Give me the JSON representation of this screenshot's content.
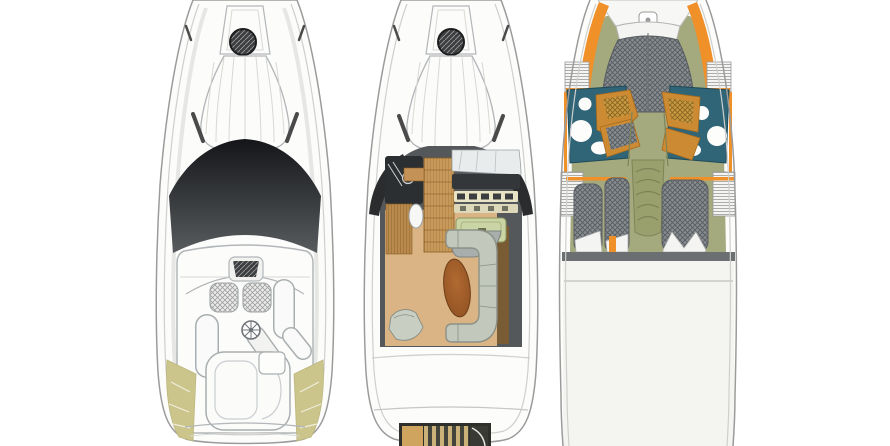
{
  "image": {
    "kind": "yacht-floorplan-diagram",
    "description": "Three top-down deck plans of a motor yacht: exterior deck plan, main deck plan, lower deck accommodation plan",
    "background": "#ffffff"
  },
  "views": [
    {
      "id": "exterior-deck-plan",
      "position": "left",
      "features": [
        "anchor-locker",
        "bow-hatch",
        "bow-sunpad",
        "grab-rails",
        "windshield",
        "helm-seats",
        "steering-wheel",
        "side-benches",
        "stern-sunpad",
        "khaki-trim",
        "swim-platform"
      ]
    },
    {
      "id": "main-deck-plan",
      "position": "center",
      "features": [
        "anchor-locker",
        "bow-hatch",
        "bow-sunpad",
        "cockpit-surround",
        "galley",
        "wood-cabinet",
        "helm-dashboard",
        "chart-table",
        "helm-seat",
        "salon-floor",
        "c-shaped-sofa",
        "oval-table",
        "chair",
        "transom",
        "engine-hatch"
      ]
    },
    {
      "id": "lower-deck-plan",
      "position": "right",
      "features": [
        "foredeck",
        "anchor-fitting",
        "v-berth",
        "head-port",
        "head-starboard",
        "vanity-seats",
        "wardrobe-lockers",
        "companionway-stairs",
        "aft-berths",
        "pillows",
        "bulkhead-band",
        "hull-seam"
      ]
    }
  ],
  "colors": {
    "background": "#ffffff",
    "hull_fill": "#fcfcfb",
    "hull_line": "#9b9b9b",
    "hull_inner_line": "#cfcfcd",
    "hull_soft_line": "#e6e6e4",
    "detail_line": "#b2b6b8",
    "faint_line": "#d8d8d6",
    "glass_dark": "#141518",
    "glass_mid": "#585c5e",
    "hatch_circle": "#3c3e40",
    "hatch_circle_line": "#9a9d9f",
    "seat_hatch_bg": "#ebebea",
    "seat_hatch_line": "#a0a0a0",
    "gray_fixture": "#a9aeb0",
    "khaki": "#cbc58b",
    "khaki_line": "#bdb77f",
    "house_dark": "#54585a",
    "wing_dark": "#2a2c2e",
    "counter_dark": "#2c2f31",
    "wood_light": "#c79a5c",
    "wood_grain": "#9a6c2c",
    "wood_floor": "#b98a4e",
    "wood_edge": "#8a5c22",
    "cream_panel": "#e9e4c6",
    "cream_panel2": "#ddd8ba",
    "gauge_dark": "#3a3e40",
    "chart_table_green": "#cad4a4",
    "chart_table_line": "#8f9960",
    "tan_floor": "#dab484",
    "table_brown_light": "#b06a32",
    "table_brown_dark": "#8c4e20",
    "table_edge": "#6e3d18",
    "sofa_gray": "#c2c8bb",
    "sofa_line": "#8b9188",
    "chair_gray": "#c9cec3",
    "sofa_back_strip": "#7a5c34",
    "olive_floor": "#a5a97e",
    "olive_dark": "#7e8457",
    "stair_olive": "#99a06d",
    "orange": "#ef9029",
    "vanity_orange": "#cc8a33",
    "vanity_tan": "#c89a42",
    "vanity_tan_line": "#8a6420",
    "teal": "#2f6577",
    "teal_line": "#1f4a58",
    "berth_gray": "#868c90",
    "berth_line": "#565c60",
    "pillow": "#f4f4f2",
    "band_gray": "#6b6f71",
    "hull_lower_tint": "#f4f4f1",
    "hatch_frame": "#2e2e2a",
    "hatch_tan": "#cfa45e",
    "hatch_stripe_light": "#c9b178",
    "hatch_stripe_dark": "#43443c",
    "locker_line": "#9a9a98",
    "dark_mark": "#4a4a4a"
  }
}
